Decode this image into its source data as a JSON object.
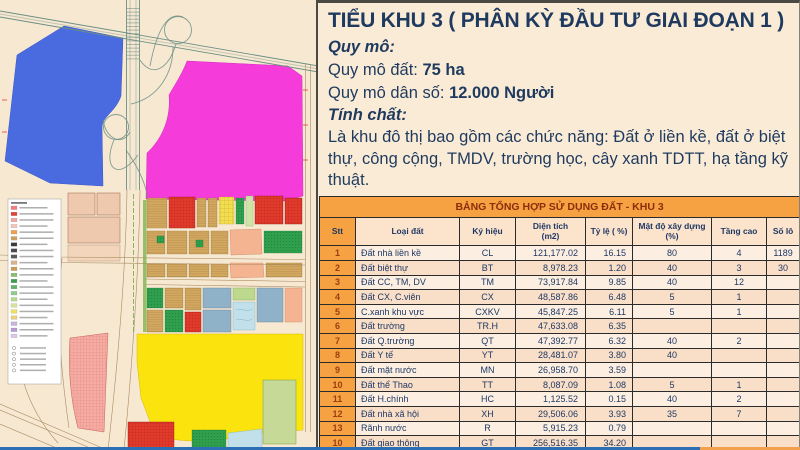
{
  "panel": {
    "title": "TIỂU KHU 3 ( PHÂN KỲ ĐẦU TƯ GIAI ĐOẠN 1 )",
    "quy_mo_label": "Quy mô:",
    "quy_mo_dat_label": "Quy mô đất: ",
    "quy_mo_dat_value": "75 ha",
    "quy_mo_dan_so_label": "Quy mô dân số: ",
    "quy_mo_dan_so_value": "12.000 Người",
    "tinh_chat_label": "Tính chất:",
    "tinh_chat_text": "Là khu đô thị bao gồm các chức năng: Đất ở liền kề, đất ở biệt thự, công cộng, TMDV, trường học, cây xanh TDTT, hạ tầng kỹ thuật."
  },
  "table": {
    "title": "BẢNG TỔNG HỢP SỬ DỤNG ĐẤT - KHU 3",
    "columns": [
      "Stt",
      "Loại đất",
      "Ký hiệu",
      "Diện tích\n(m2)",
      "Tỷ lệ ( %)",
      "Mật độ xây dựng\n(%)",
      "Tầng cao",
      "Số lô"
    ],
    "rows": [
      {
        "stt": "1",
        "loai_dat": "Đất nhà liền kề",
        "ky_hieu": "CL",
        "dien_tich": "121,177.02",
        "ty_le": "16.15",
        "mat_do": "80",
        "tang_cao": "4",
        "so_lo": "1189"
      },
      {
        "stt": "2",
        "loai_dat": "Đất biệt thự",
        "ky_hieu": "BT",
        "dien_tich": "8,978.23",
        "ty_le": "1.20",
        "mat_do": "40",
        "tang_cao": "3",
        "so_lo": "30"
      },
      {
        "stt": "3",
        "loai_dat": "Đất CC, TM, DV",
        "ky_hieu": "TM",
        "dien_tich": "73,917.84",
        "ty_le": "9.85",
        "mat_do": "40",
        "tang_cao": "12",
        "so_lo": ""
      },
      {
        "stt": "4",
        "loai_dat": "Đất CX, C.viên",
        "ky_hieu": "CX",
        "dien_tich": "48,587.86",
        "ty_le": "6.48",
        "mat_do": "5",
        "tang_cao": "1",
        "so_lo": ""
      },
      {
        "stt": "5",
        "loai_dat": "C.xanh khu vực",
        "ky_hieu": "CXKV",
        "dien_tich": "45,847.25",
        "ty_le": "6.11",
        "mat_do": "5",
        "tang_cao": "1",
        "so_lo": ""
      },
      {
        "stt": "6",
        "loai_dat": "Đất trường",
        "ky_hieu": "TR.H",
        "dien_tich": "47,633.08",
        "ty_le": "6.35",
        "mat_do": "",
        "tang_cao": "",
        "so_lo": ""
      },
      {
        "stt": "7",
        "loai_dat": "Đất Q.trường",
        "ky_hieu": "QT",
        "dien_tich": "47,392.77",
        "ty_le": "6.32",
        "mat_do": "40",
        "tang_cao": "2",
        "so_lo": ""
      },
      {
        "stt": "8",
        "loai_dat": "Đất Y tế",
        "ky_hieu": "YT",
        "dien_tich": "28,481.07",
        "ty_le": "3.80",
        "mat_do": "40",
        "tang_cao": "",
        "so_lo": ""
      },
      {
        "stt": "9",
        "loai_dat": "Đất mặt nước",
        "ky_hieu": "MN",
        "dien_tich": "26,958.70",
        "ty_le": "3.59",
        "mat_do": "",
        "tang_cao": "",
        "so_lo": ""
      },
      {
        "stt": "10",
        "loai_dat": "Đất thể Thao",
        "ky_hieu": "TT",
        "dien_tich": "8,087.09",
        "ty_le": "1.08",
        "mat_do": "5",
        "tang_cao": "1",
        "so_lo": ""
      },
      {
        "stt": "11",
        "loai_dat": "Đất H.chính",
        "ky_hieu": "HC",
        "dien_tich": "1,125.52",
        "ty_le": "0.15",
        "mat_do": "40",
        "tang_cao": "2",
        "so_lo": ""
      },
      {
        "stt": "12",
        "loai_dat": "Đất nhà xã hội",
        "ky_hieu": "XH",
        "dien_tich": "29,506.06",
        "ty_le": "3.93",
        "mat_do": "35",
        "tang_cao": "7",
        "so_lo": ""
      },
      {
        "stt": "13",
        "loai_dat": "Rãnh nước",
        "ky_hieu": "R",
        "dien_tich": "5,915.23",
        "ty_le": "0.79",
        "mat_do": "",
        "tang_cao": "",
        "so_lo": ""
      },
      {
        "stt": "10",
        "loai_dat": "Đất giao thông",
        "ky_hieu": "GT",
        "dien_tich": "256,516.35",
        "ty_le": "34.20",
        "mat_do": "",
        "tang_cao": "",
        "so_lo": ""
      },
      {
        "stt": "10",
        "loai_dat": "Tổng",
        "ky_hieu": "",
        "dien_tich": "750,125.07",
        "ty_le": "100.00",
        "mat_do": "",
        "tang_cao": "",
        "so_lo": "",
        "bold": true
      }
    ]
  },
  "map": {
    "label": "Xã Yên Phú",
    "legend_swatches": [
      "#f08080",
      "#e34234",
      "#f4a6a0",
      "#f7c8b8",
      "#f49e4c",
      "#caa05e",
      "#3a3a3a",
      "#4a4a4a",
      "#5a5a5a",
      "#d9b38c",
      "#c99c54",
      "#8fbc6f",
      "#3f9e4d",
      "#62b46a",
      "#8fca8f",
      "#b5d98a",
      "#d7e39a",
      "#f2e05a",
      "#e8d27a",
      "#c9b2d9",
      "#b89ad1",
      "#e0c9e8"
    ]
  },
  "colors": {
    "panel_bg": "#FAEBD6",
    "panel_border": "#4A4A42",
    "body_text": "#1E3A5F",
    "table_border": "#2B2B2B",
    "table_title_bg": "#F6A243",
    "table_title_text": "#8A2E0C",
    "header_bg": "#FBE3CC",
    "stt_bg": "#F6A243",
    "stt_text": "#9A3E10",
    "row_light": "#FCEFE1",
    "row_dark": "#F9DFC7",
    "cell_text": "#1F3864",
    "bottom_blue": "#2C6FB5",
    "bottom_orange": "#F2A04C",
    "map_bg": "#F7E8D1",
    "zone_blue": "#4A6BE0",
    "zone_magenta": "#F53BD9",
    "zone_yellow": "#FBE40D",
    "zone_salmon_hatch": "#F4ACA4",
    "block_red": "#E23B2C",
    "block_red_line": "#A61F12",
    "block_tan": "#D2A75F",
    "block_tan_line": "#8A6A30",
    "block_green": "#2F9E4D",
    "block_green_dot": "#1C7A35",
    "block_bluegray": "#8FB2C8",
    "block_salmon": "#F5B491",
    "block_yellow": "#F2DE4E",
    "pond": "#C2E0EA",
    "road_teal": "#6B8F85",
    "road_brown": "#A98B62",
    "lightgreen_block": "#C6D996",
    "parcel_tan": "#EFC9AD"
  }
}
